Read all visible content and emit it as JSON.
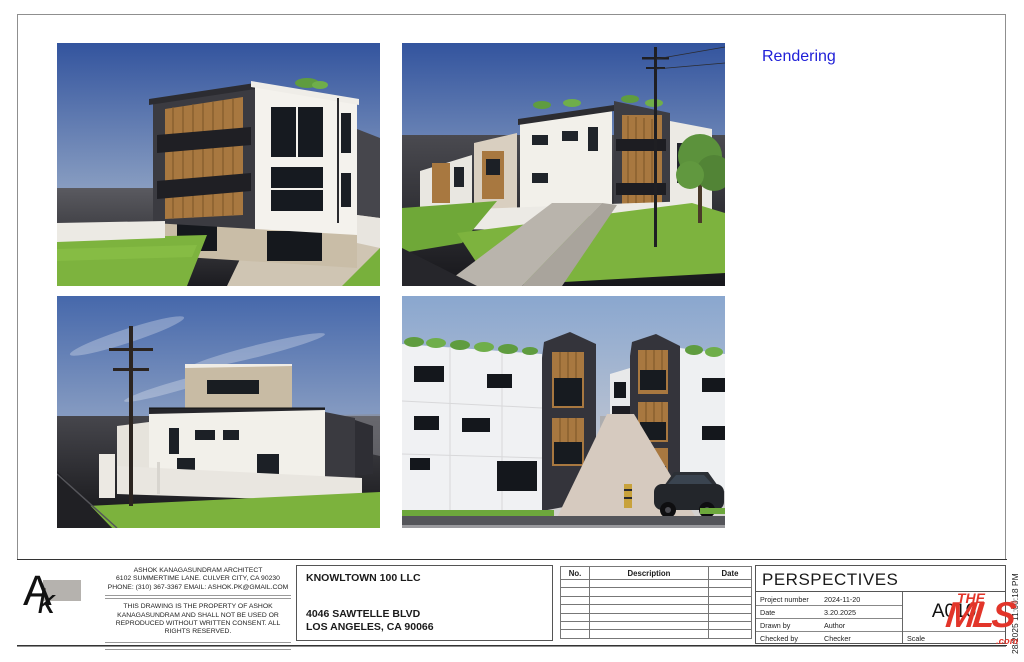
{
  "annotations": {
    "rendering_label": "Rendering",
    "plot_stamp": "28/2025 11:00:18 PM"
  },
  "colors": {
    "rendering_label_blue": "#2020d8",
    "watermark_red": "#e2352a",
    "sky_blue": "#33549e",
    "grass_green": "#7db33e",
    "wood_accent": "#a87840",
    "charcoal": "#36363c"
  },
  "architect": {
    "logo_letter_a": "A",
    "logo_letter_k": "k",
    "name": "ASHOK KANAGASUNDRAM ARCHITECT",
    "address": "6102 SUMMERTIME LANE.  CULVER CITY, CA 90230",
    "contact": "PHONE: (310) 367-3367    EMAIL: ASHOK.PK@GMAIL.COM",
    "copyright": "THIS DRAWING IS THE PROPERTY OF ASHOK KANAGASUNDRAM AND SHALL NOT BE USED OR REPRODUCED WITHOUT WRITTEN CONSENT. ALL RIGHTS RESERVED."
  },
  "client": {
    "name": "KNOWLTOWN 100 LLC",
    "address_line1": "4046 SAWTELLE BLVD",
    "address_line2": "LOS ANGELES, CA 90066"
  },
  "revision_table": {
    "headers": [
      "No.",
      "Description",
      "Date"
    ],
    "empty_rows": 7
  },
  "sheet": {
    "title": "PERSPECTIVES",
    "fields": [
      {
        "label": "Project number",
        "value": "2024-11-20"
      },
      {
        "label": "Date",
        "value": "3.20.2025"
      },
      {
        "label": "Drawn by",
        "value": "Author"
      },
      {
        "label": "Checked by",
        "value": "Checker"
      }
    ],
    "number": "A010",
    "scale_label": "Scale"
  },
  "watermark": {
    "the": "THE",
    "mls": "MLS",
    "tm": "™",
    "com": ".com"
  }
}
